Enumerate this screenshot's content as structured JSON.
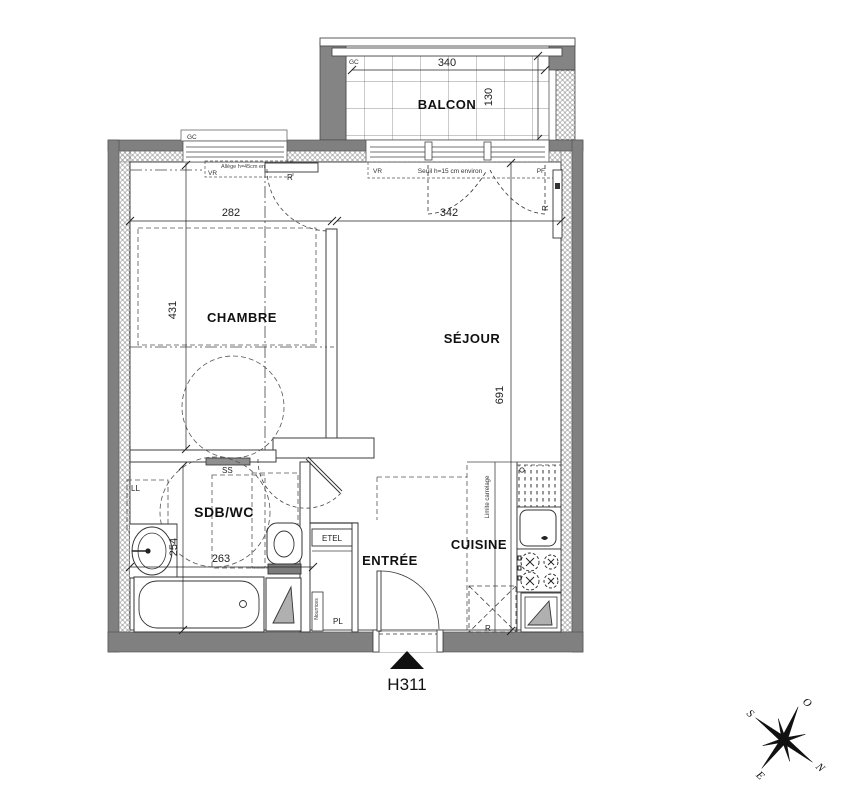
{
  "plan": {
    "unit_label": "H311",
    "balcony": {
      "name": "BALCON",
      "gc": "GC",
      "dim_width": "340",
      "dim_depth": "130"
    },
    "chambre": {
      "name": "CHAMBRE",
      "dim_width": "282",
      "dim_height": "431",
      "radiator": "R",
      "window_gc": "GC",
      "window_vr": "VR",
      "window_allege": "Allège h=45cm environ"
    },
    "sejour": {
      "name": "SÉJOUR",
      "dim_width": "342",
      "dim_height": "691",
      "radiator": "R",
      "bay": {
        "vr": "VR",
        "seuil": "Seuil h=15 cm environ",
        "pf": "PF"
      }
    },
    "sdb": {
      "name": "SDB/WC",
      "dim_width": "263",
      "dim_height": "254",
      "towel_rail": "SS",
      "washer": "LL"
    },
    "entree": {
      "name": "ENTRÉE"
    },
    "cuisine": {
      "name": "CUISINE",
      "tile_limit": "Limite carrelage",
      "fridge": "R"
    },
    "closet": {
      "name": "ETEL",
      "pl": "PL",
      "manifold": "Nourrices"
    },
    "compass": {
      "n": "N",
      "s": "S",
      "e": "E",
      "o": "O"
    }
  },
  "colors": {
    "wall": "#808080",
    "wall_dark": "#5e5e5e",
    "line": "#2b2b2b",
    "light_gray": "#b0b0b0",
    "paper": "#ffffff"
  }
}
